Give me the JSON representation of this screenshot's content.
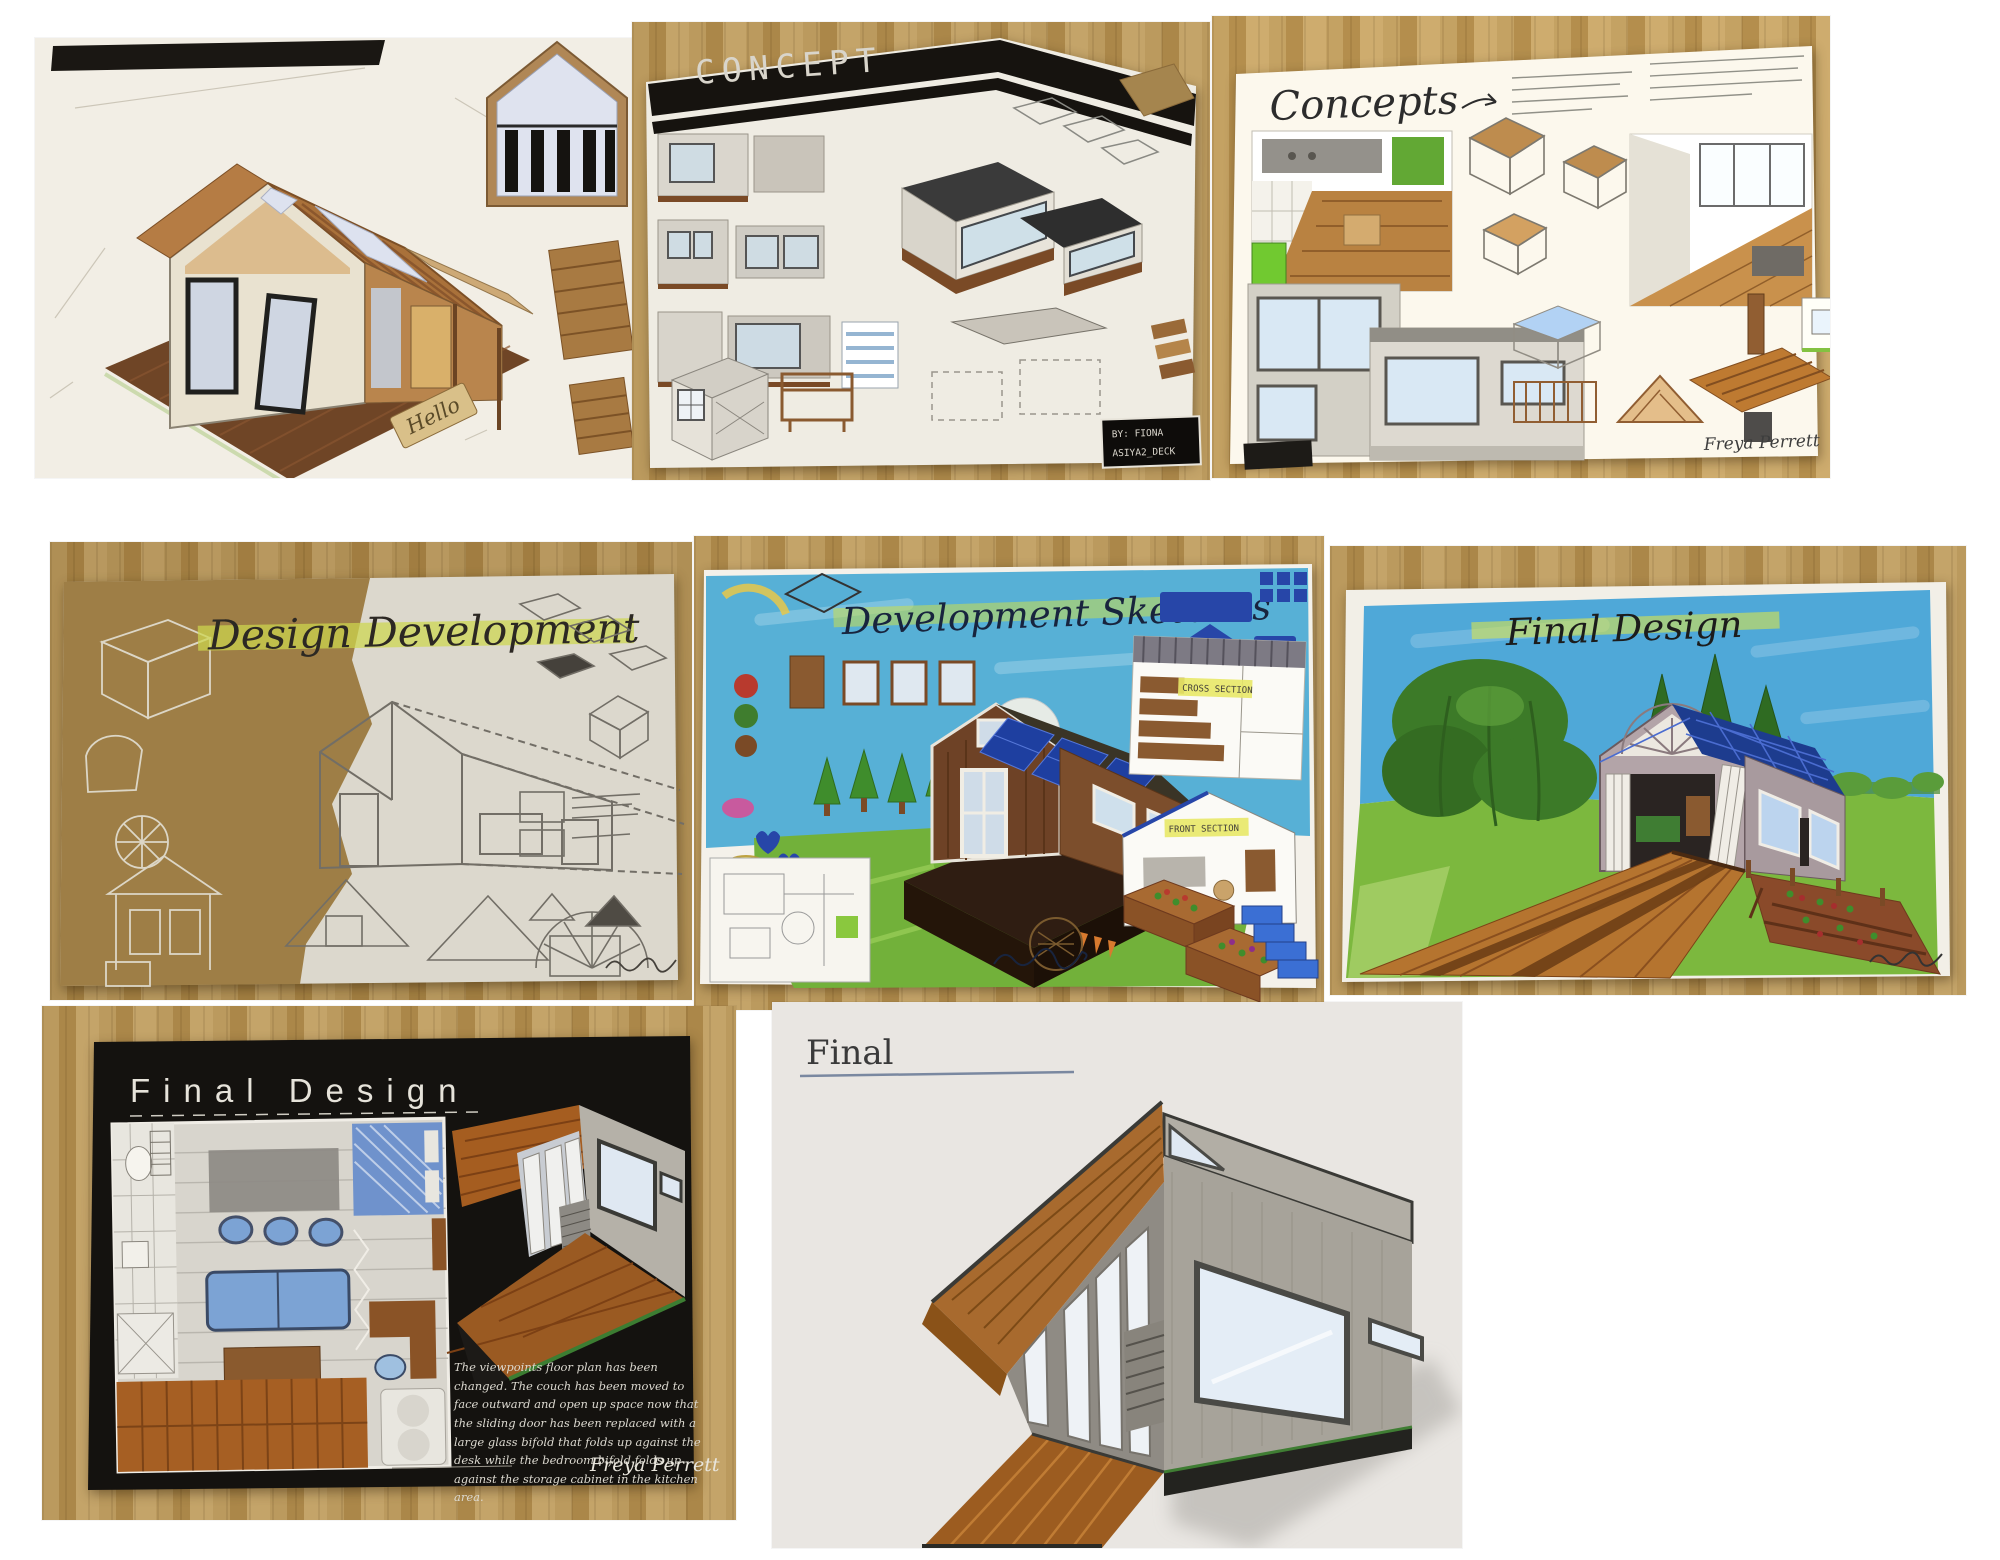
{
  "collage": {
    "description": "Eight photographs of hand-drawn tiny-house design coursework laid out on wooden desks"
  },
  "photos": {
    "cabin": {
      "label": "isometric cabin concept drawing",
      "doormat": "Hello"
    },
    "concept": {
      "title": "CONCEPT",
      "credit1": "BY: FIONA",
      "credit2": "ASIYA2_DECK"
    },
    "concepts": {
      "title": "Concepts",
      "signature": "Freya Perrett"
    },
    "design_development": {
      "title": "Design Development"
    },
    "development_sketches": {
      "title": "Development Sketches",
      "label_cross": "CROSS SECTION",
      "label_front": "FRONT SECTION"
    },
    "final_design_color": {
      "title": "Final Design"
    },
    "final_design_plan": {
      "title": "Final Design",
      "notes": "The viewpoints floor plan has been changed. The couch has been moved to face outward and open up space now that the sliding door has been replaced with a large glass bifold that folds up against the desk while the bedroom bifold folds up against the storage cabinet in the kitchen area.",
      "signature": "Freya Perrett"
    },
    "final_perspective": {
      "title": "Final"
    }
  },
  "colors": {
    "desk_wood": "#b3924f",
    "paper": "#f2eee5",
    "black_banner": "#16130f",
    "kraft": "#a8884e",
    "sky_blue": "#57b0d6",
    "grass_green": "#72b13a",
    "solar_blue": "#1e3fa0",
    "cabin_wood": "#a9713a",
    "highlight_yellow": "#dce65a",
    "black_paper": "#14120f"
  }
}
